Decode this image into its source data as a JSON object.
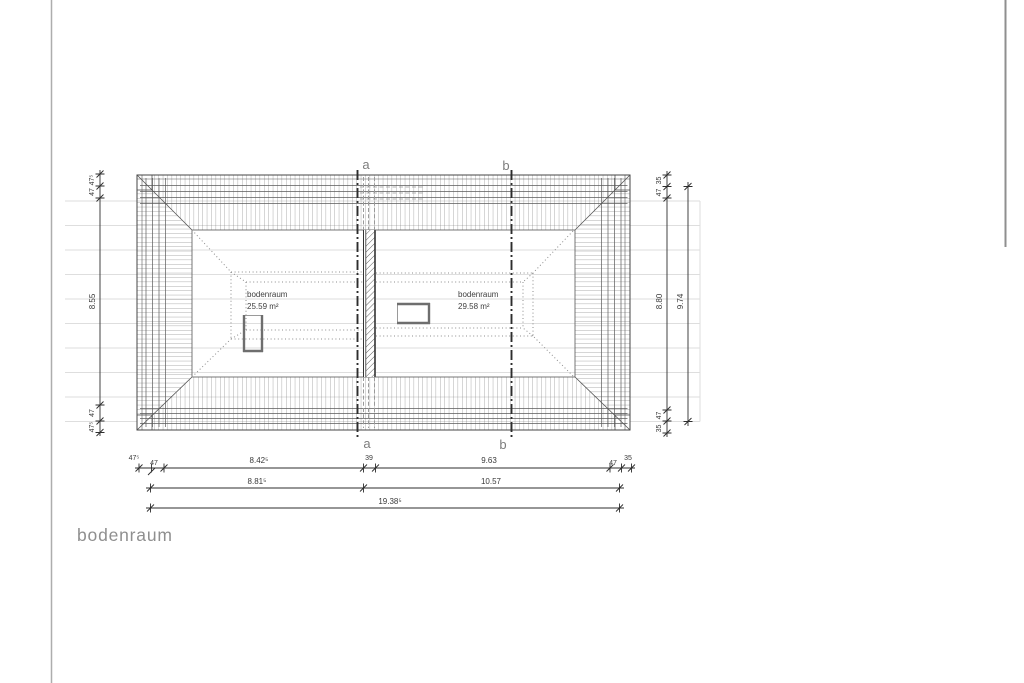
{
  "title": "bodenraum",
  "rooms": [
    {
      "name": "bodenraum",
      "area": "25.59 m²"
    },
    {
      "name": "bodenraum",
      "area": "29.58 m²"
    }
  ],
  "sections": {
    "a": "a",
    "b": "b"
  },
  "dims": {
    "row1": [
      "47⁵",
      "47",
      "8.42⁵",
      "39",
      "9.63",
      "47",
      "35"
    ],
    "row2": [
      "8.81⁵",
      "10.57"
    ],
    "row3": [
      "19.38⁵"
    ],
    "left": [
      "47⁵",
      "47",
      "8.55",
      "47",
      "47⁵"
    ],
    "right_inner": [
      "35",
      "47",
      "8.80",
      "47",
      "35"
    ],
    "right_outer": [
      "9.74"
    ]
  }
}
